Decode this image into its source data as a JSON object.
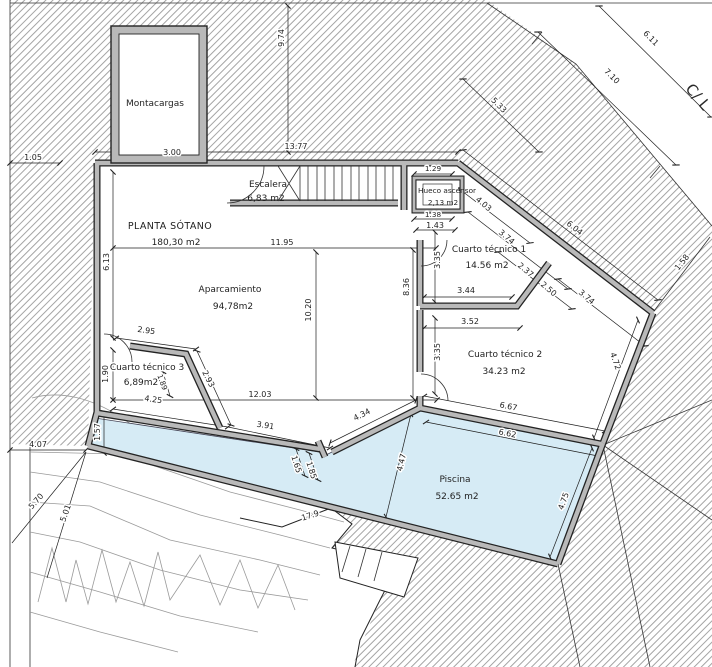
{
  "drawing_type": "basement floor plan",
  "colors": {
    "wall_gray": "#b9b9b9",
    "pool_blue": "#d6ebf5",
    "hatch_gray": "#737373",
    "ink": "#1f1f1f"
  },
  "street": {
    "label": "C/ L"
  },
  "terrain": {
    "contour_label": "17.9"
  },
  "rooms": {
    "montacargas": {
      "name": "Montacargas"
    },
    "escalera": {
      "name": "Escalera",
      "area": "6,83 m2"
    },
    "hueco_ascensor": {
      "name": "Hueco ascensor",
      "area": "2,13 m2"
    },
    "planta_sotano": {
      "name": "PLANTA SÓTANO",
      "area": "180,30 m2"
    },
    "aparcamiento": {
      "name": "Aparcamiento",
      "area": "94,78m2"
    },
    "cuarto_tecnico_1": {
      "name": "Cuarto técnico 1",
      "area": "14.56 m2"
    },
    "cuarto_tecnico_2": {
      "name": "Cuarto técnico 2",
      "area": "34.23 m2"
    },
    "cuarto_tecnico_3": {
      "name": "Cuarto técnico 3",
      "area": "6,89m2"
    },
    "piscina": {
      "name": "Piscina",
      "area": "52.65 m2"
    }
  },
  "dims": {
    "d3_00": "3.00",
    "d13_77": "13.77",
    "d9_74": "9.74",
    "d1_05": "1.05",
    "d6_11": "6.11",
    "d7_10": "7.10",
    "d5_33": "5.33",
    "d6_04": "6.04",
    "d1_58": "1.58",
    "d6_13": "6.13",
    "d11_95": "11.95",
    "d10_20": "10.20",
    "d12_03": "12.03",
    "d1_29": "1.29",
    "d1_38": "1.38",
    "d1_43": "1.43",
    "d3_35a": "3.35",
    "d8_36": "8.36",
    "d3_44": "3.44",
    "d3_52": "3.52",
    "d3_35b": "3.35",
    "d4_03": "4.03",
    "d3_74a": "3.74",
    "d2_37": "2.37",
    "d2_50": "2.50",
    "d3_74b": "3.74",
    "d4_72": "4.72",
    "d2_95": "2.95",
    "d1_90": "1.90",
    "d1_89": "1.89",
    "d2_93": "2.93",
    "d4_25": "4.25",
    "d3_91": "3.91",
    "d1_57": "1.57",
    "d4_07": "4.07",
    "d5_70": "5.70",
    "d5_01": "5.01",
    "d1_65": "1.65",
    "d1_85": "1.85",
    "d4_34": "4.34",
    "d4_47": "4.47",
    "d6_67": "6.67",
    "d6_62": "6.62",
    "d4_75": "4.75"
  }
}
